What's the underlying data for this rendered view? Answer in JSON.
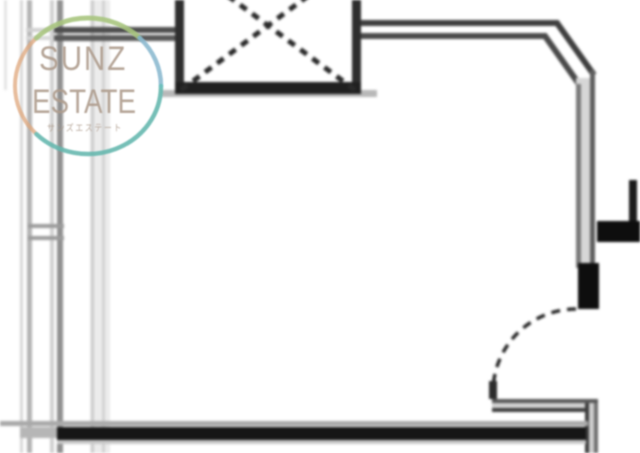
{
  "logo": {
    "line1": "SUNZ",
    "line2": "ESTATE",
    "line3": "サンズエステート",
    "text_color": "#ae9c8d",
    "ring_colors": {
      "orange": "#dfa87e",
      "green": "#a3c87e",
      "blue": "#84bbd8",
      "teal": "#5ab9b4"
    }
  },
  "drawing": {
    "background": "#ffffff",
    "ink": "#1d1d1d",
    "wall_gray": "#8f8f8f",
    "light_gray": "#d4d4d4",
    "elements": {
      "shaft": "elevator-shaft-with-cross",
      "door": "door-swing-arc",
      "walls": "room-walls"
    }
  }
}
